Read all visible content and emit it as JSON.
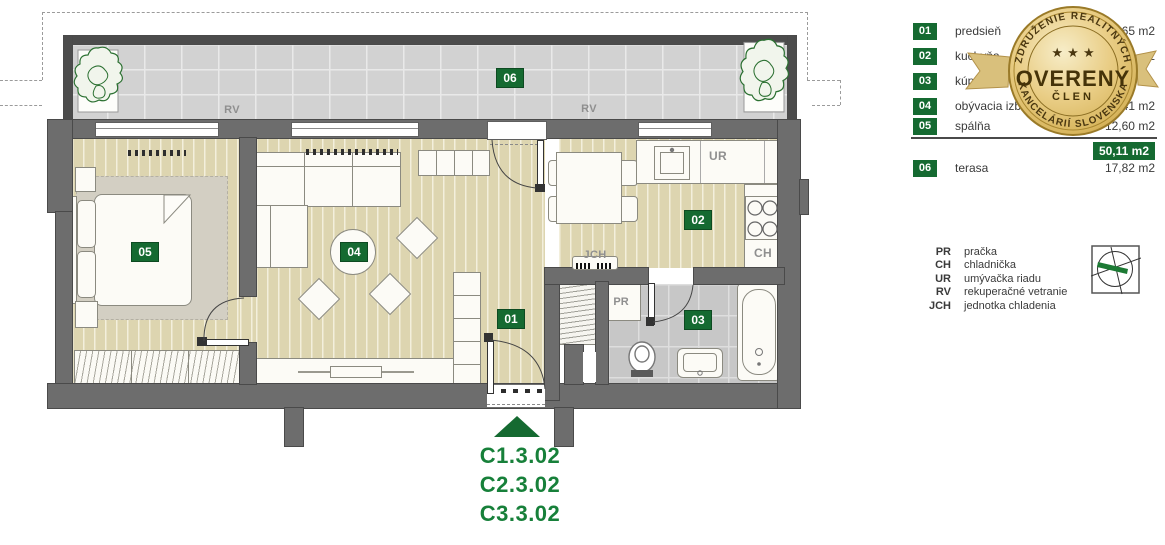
{
  "plan": {
    "badges": {
      "r01": "01",
      "r02": "02",
      "r03": "03",
      "r04": "04",
      "r05": "05",
      "r06": "06"
    },
    "labels": {
      "rv": "RV",
      "ur": "UR",
      "ch": "CH",
      "pr": "PR",
      "jch": "JCH"
    },
    "unit_codes": [
      "C1.3.02",
      "C2.3.02",
      "C3.3.02"
    ]
  },
  "legend": {
    "rows": [
      {
        "num": "01",
        "name": "predsieň",
        "area": "65 m2"
      },
      {
        "num": "02",
        "name": "kuchyňa",
        "area": "2"
      },
      {
        "num": "03",
        "name": "kúpeľňa",
        "area": ""
      },
      {
        "num": "04",
        "name": "obývacia izba",
        "area": ",41 m2"
      },
      {
        "num": "05",
        "name": "spálňa",
        "area": "12,60 m2"
      }
    ],
    "total_area": "50,11 m2",
    "extra_row": {
      "num": "06",
      "name": "terasa",
      "area": "17,82 m2"
    }
  },
  "abbreviations": [
    {
      "abbr": "PR",
      "label": "pračka"
    },
    {
      "abbr": "CH",
      "label": "chladnička"
    },
    {
      "abbr": "UR",
      "label": "umývačka riadu"
    },
    {
      "abbr": "RV",
      "label": "rekuperačné vetranie"
    },
    {
      "abbr": "JCH",
      "label": "jednotka chladenia"
    }
  ],
  "seal": {
    "arc_top": "ZDRUŽENIE REALITNÝCH",
    "arc_bottom": "KANCELÁRIÍ SLOVENSKA",
    "stars": "★ ★ ★",
    "title": "OVERENÝ",
    "subtitle": "ČLEN"
  },
  "colors": {
    "accent_green": "#156a31",
    "code_green": "#17803a",
    "gold": "#d9bc6b",
    "wall_gray": "#6d6d6d"
  }
}
